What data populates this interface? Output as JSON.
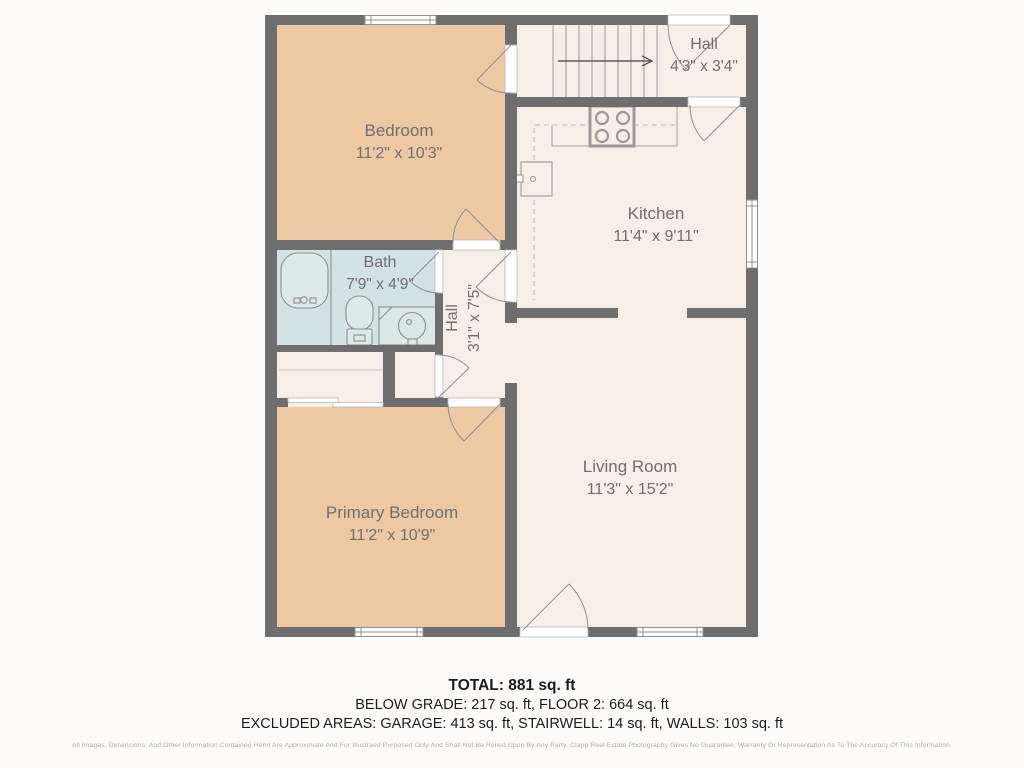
{
  "floorplan": {
    "rooms": {
      "bedroom": {
        "label": "Bedroom",
        "dims": "11'2\" x 10'3\""
      },
      "hall_upper": {
        "label": "Hall",
        "dims": "4'3\" x 3'4\""
      },
      "kitchen": {
        "label": "Kitchen",
        "dims": "11'4\" x 9'11\""
      },
      "bath": {
        "label": "Bath",
        "dims": "7'9\" x 4'9\""
      },
      "hall_lower": {
        "label": "Hall",
        "dims": "3'1\" x 7'5\""
      },
      "living_room": {
        "label": "Living Room",
        "dims": "11'3\" x 15'2\""
      },
      "primary_bedroom": {
        "label": "Primary Bedroom",
        "dims": "11'2\" x 10'9\""
      }
    },
    "colors": {
      "wall": "#6e6e6e",
      "room_cream": "#f6efe8",
      "room_peach": "#ecc9a3",
      "room_bath": "#d2e2e2",
      "fixture_outline": "#8f8f8f"
    }
  },
  "summary": {
    "total": "TOTAL: 881 sq. ft",
    "line2": "BELOW GRADE: 217 sq. ft, FLOOR 2: 664 sq. ft",
    "line3": "EXCLUDED AREAS: GARAGE: 413 sq. ft, STAIRWELL: 14 sq. ft, WALLS: 103 sq. ft"
  },
  "disclaimer": "All Images, Dimensions, And Other Information Contained Herin Are Approximate And For Illustraed Purposed Only And Shall Not Be Relied Upon By Any Party. Clapp Real Estate Photography Gives No Guarantee, Warranty Or Representation As To The Accuracy Of This Information."
}
